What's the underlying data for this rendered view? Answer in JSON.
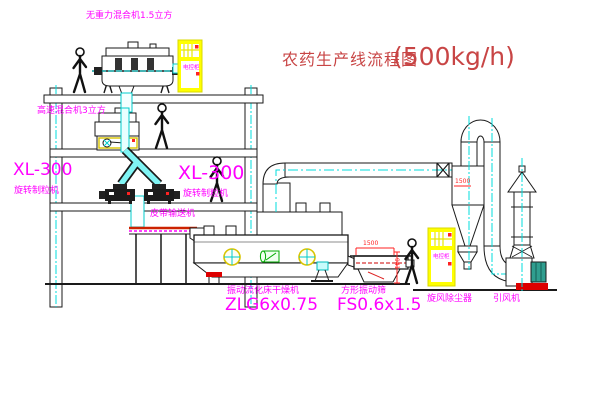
{
  "title": {
    "name": "农药生产线流程图",
    "capacity": "(500kg/h)"
  },
  "labels": {
    "mixer_top": "无重力混合机1.5立方",
    "mixer_highspeed": "高速混合机3立方",
    "granulator_left_model": "XL-300",
    "granulator_left_name": "旋转制粒机",
    "granulator_right_model": "XL-300",
    "granulator_right_name": "旋转制粒机",
    "belt_conveyor": "皮带输送机",
    "dryer_name": "振动流化床干燥机",
    "dryer_model": "ZLG6x0.75",
    "screen_name": "方形振动筛",
    "screen_model": "FS0.6x1.5",
    "cyclone": "旋风除尘器",
    "fan": "引风机",
    "control_cabinet_1": "电控柜",
    "control_cabinet_2": "电控柜"
  },
  "dimensions": {
    "screen_length": "1500",
    "screen_height": "941",
    "cyclone": "1500"
  },
  "colors": {
    "label_magenta": "#ff00ff",
    "title_red": "#c84545",
    "centerline_cyan": "#00dddd",
    "cabinet_yellow": "#ffff00",
    "line_black": "#1a1a1a",
    "detail_red": "#ff2222"
  }
}
